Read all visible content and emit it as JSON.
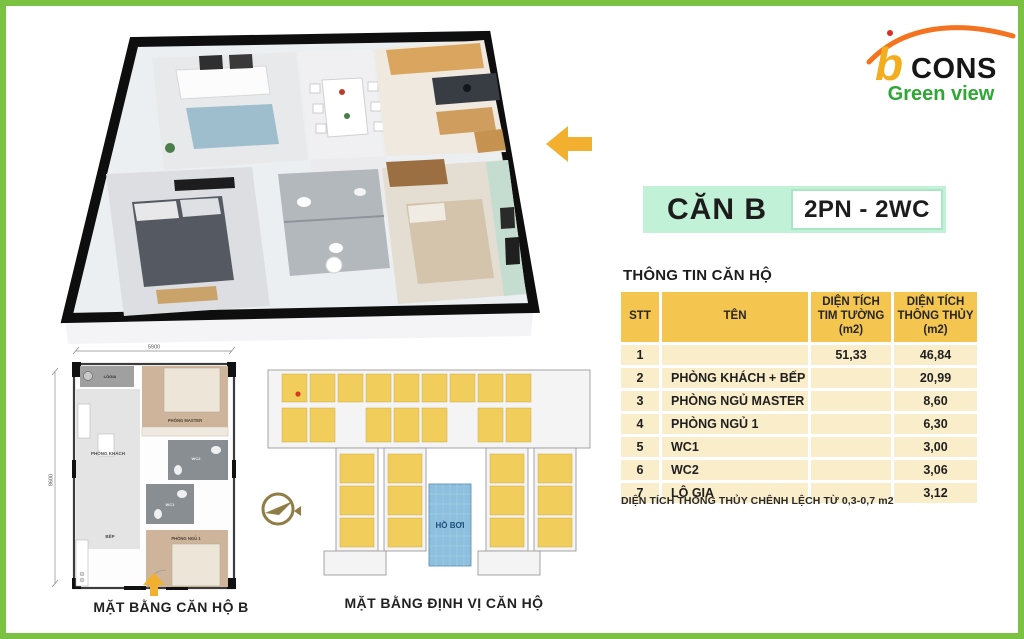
{
  "brand": {
    "logo_b": "b",
    "logo_cons": "CONS",
    "logo_sub": "Green view",
    "color_orange": "#f4731f",
    "color_yellow": "#f2ae1c",
    "color_green": "#2fa734"
  },
  "header": {
    "unit_title": "CĂN B",
    "unit_spec": "2PN - 2WC"
  },
  "info": {
    "section_title": "THÔNG TIN CĂN HỘ",
    "table": {
      "headers": [
        "STT",
        "TÊN",
        "DIỆN TÍCH\nTIM TƯỜNG\n(m2)",
        "DIỆN TÍCH\nTHÔNG THỦY\n(m2)"
      ],
      "rows": [
        {
          "stt": "1",
          "ten": "",
          "tim_tuong": "51,33",
          "thong_thuy": "46,84"
        },
        {
          "stt": "2",
          "ten": "PHÒNG KHÁCH + BẾP",
          "tim_tuong": "",
          "thong_thuy": "20,99"
        },
        {
          "stt": "3",
          "ten": "PHÒNG NGỦ MASTER",
          "tim_tuong": "",
          "thong_thuy": "8,60"
        },
        {
          "stt": "4",
          "ten": "PHÒNG NGỦ 1",
          "tim_tuong": "",
          "thong_thuy": "6,30"
        },
        {
          "stt": "5",
          "ten": "WC1",
          "tim_tuong": "",
          "thong_thuy": "3,00"
        },
        {
          "stt": "6",
          "ten": "WC2",
          "tim_tuong": "",
          "thong_thuy": "3,06"
        },
        {
          "stt": "7",
          "ten": "LÔ GIA",
          "tim_tuong": "",
          "thong_thuy": "3,12"
        }
      ]
    },
    "note": "DIỆN TÍCH THÔNG THỦY CHÊNH LỆCH TỪ 0,3-0,7 m2"
  },
  "unit_plan": {
    "caption": "MẶT BẰNG CĂN HỘ B",
    "dim_width": "5900",
    "dim_height": "8600",
    "rooms": {
      "logia": "LÔGIA",
      "master": "PHÒNG MASTER",
      "living": "PHÒNG KHÁCH",
      "wc2": "WC2",
      "wc1": "WC1",
      "kitchen": "BẾP",
      "bedroom1": "PHÒNG NGỦ 1"
    }
  },
  "site_plan": {
    "caption": "MẶT BẰNG ĐỊNH VỊ CĂN HỘ",
    "pool_label": "HỒ BƠI"
  },
  "colors": {
    "frame_border": "#7cc242",
    "band_mint": "#c1f1d6",
    "table_header": "#f5c64f",
    "table_row": "#faedca",
    "arrow_yellow": "#f2b02e",
    "pool_blue": "#8cc0de",
    "site_unit_yellow": "#f1ce5c"
  }
}
